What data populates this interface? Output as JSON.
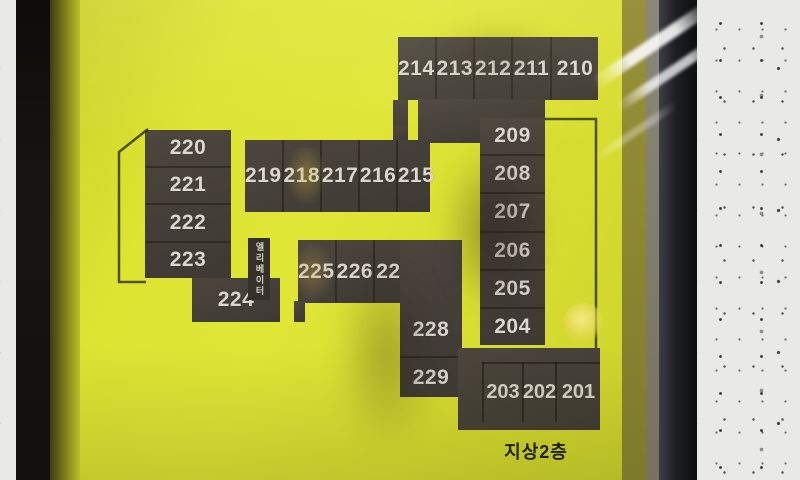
{
  "sign": {
    "floor_label": "지상2층",
    "elevator_label_left": "엘리베이터",
    "elevator_label_right": "엘리베이터",
    "rooms": {
      "top_row": [
        "214",
        "213",
        "212",
        "211",
        "210"
      ],
      "right_column": [
        "209",
        "208",
        "207",
        "206",
        "205",
        "204"
      ],
      "middle_row": [
        "219",
        "218",
        "217",
        "216",
        "215"
      ],
      "left_column": [
        "220",
        "221",
        "222",
        "223"
      ],
      "single_224": "224",
      "lower_middle_row": [
        "225",
        "226",
        "227"
      ],
      "center_stack": [
        "228",
        "229"
      ],
      "bottom_row": [
        "203",
        "202",
        "201"
      ]
    },
    "colors": {
      "sign_yellow": "#dde234",
      "room_block": "#46413a",
      "room_number_text": "#dcd7cf",
      "floor_label_text": "#1d1c12"
    }
  }
}
